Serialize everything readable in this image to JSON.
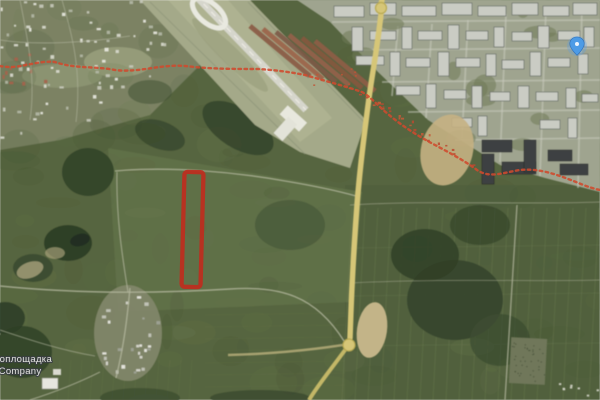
{
  "map": {
    "view_type": "satellite",
    "watermark": {
      "line1": "втоплощадка",
      "line2": "s&Company"
    },
    "plot_annotation": {
      "shape": "rectangle-outline",
      "color": "#bf2c1e"
    },
    "boundary_line": {
      "style": "dotted",
      "color": "#cf4a2e"
    },
    "location_marker": {
      "color": "#4d9be6"
    },
    "road_color": "#d6c677"
  }
}
